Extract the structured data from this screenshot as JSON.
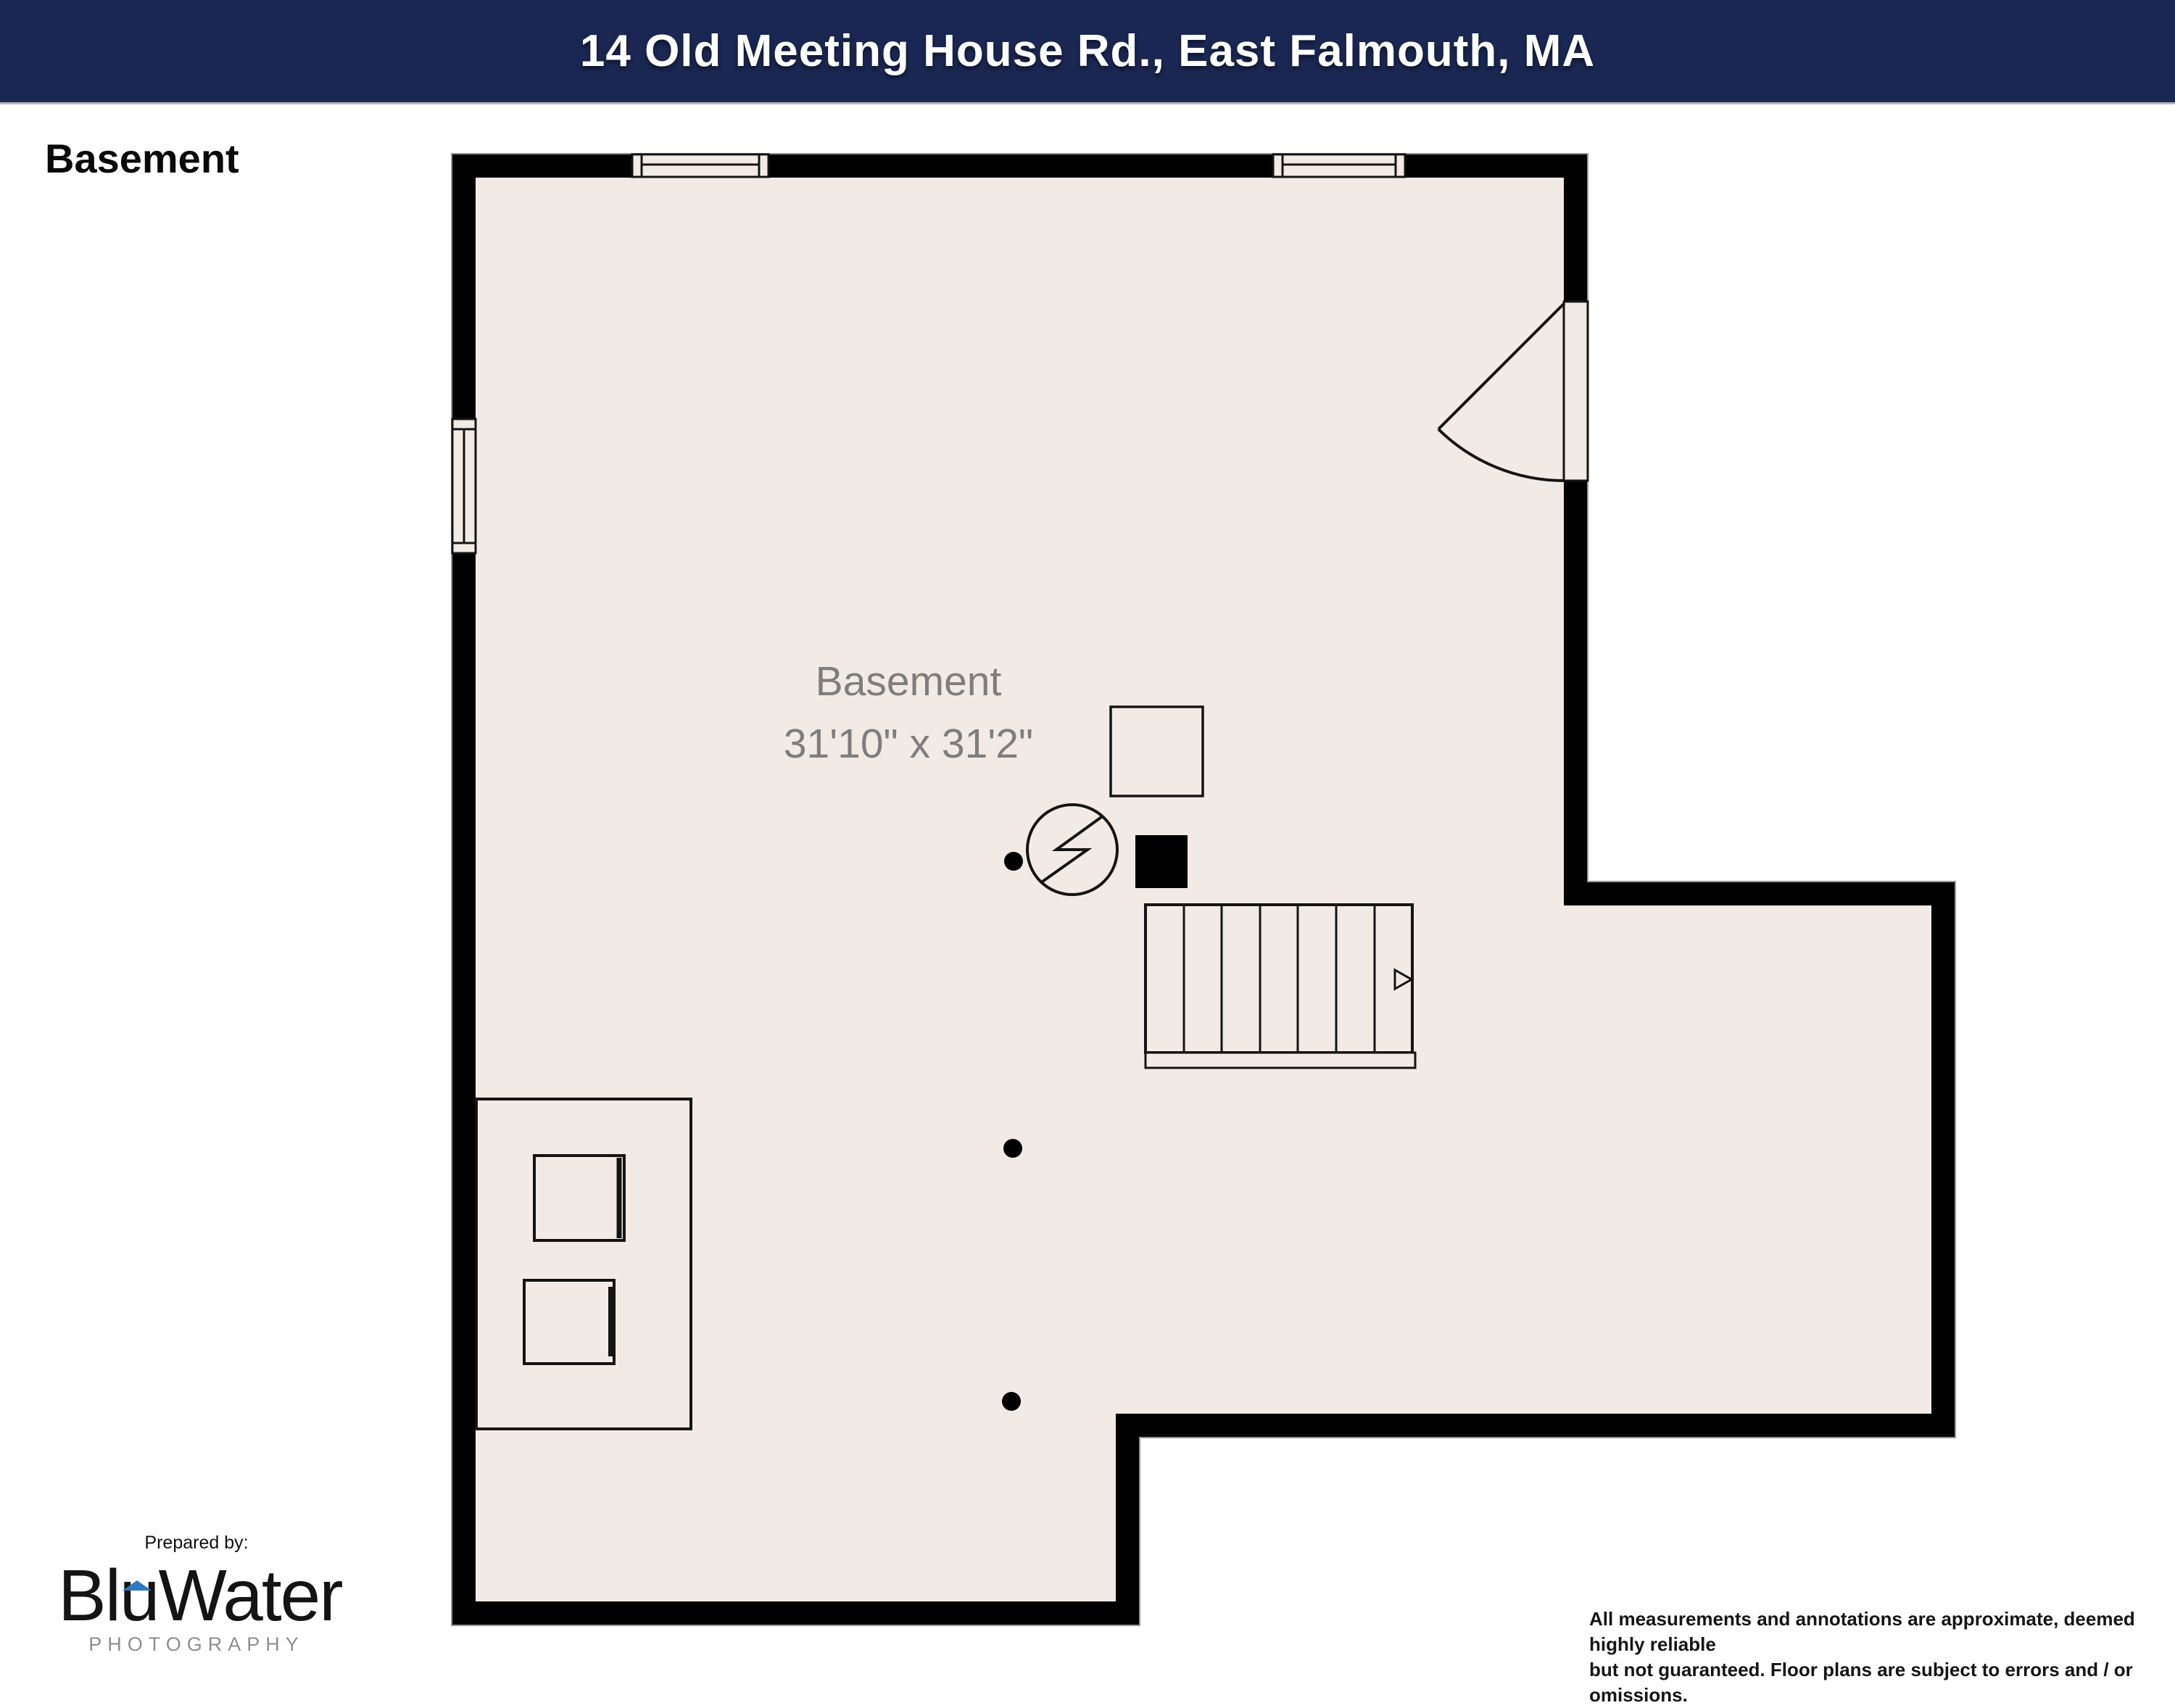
{
  "header": {
    "title": "14 Old Meeting House Rd., East Falmouth, MA"
  },
  "plan": {
    "floor_label": "Basement",
    "room": {
      "name": "Basement",
      "dimensions": "31'10\" x 31'2\""
    },
    "symbols": [
      "double-hung-window-top-left",
      "double-hung-window-top-right",
      "double-hung-window-left",
      "entry-door-with-swing",
      "staircase-with-up-arrow",
      "water-heater-circle-bolt",
      "furnace-black-square",
      "equipment-square",
      "utility-enclosure-with-two-units",
      "support-post-x3"
    ]
  },
  "branding": {
    "prepared_by": "Prepared by:",
    "logo_part1": "Blu",
    "logo_part2": "Water",
    "logo_secondary": "PHOTOGRAPHY"
  },
  "disclaimer": {
    "line1": "All measurements and annotations are approximate, deemed highly reliable",
    "line2": "but not guaranteed. Floor plans are subject to errors and / or omissions."
  },
  "colors": {
    "header_bg": "#1a2752",
    "header_text": "#ffffff",
    "floor_fill": "#f2ebe5",
    "wall": "#000000",
    "plan_line": "#141414",
    "room_label": "#7e7e7e",
    "logo_accent_blue": "#2e79c0",
    "logo_secondary_gray": "#8f8f8f"
  }
}
